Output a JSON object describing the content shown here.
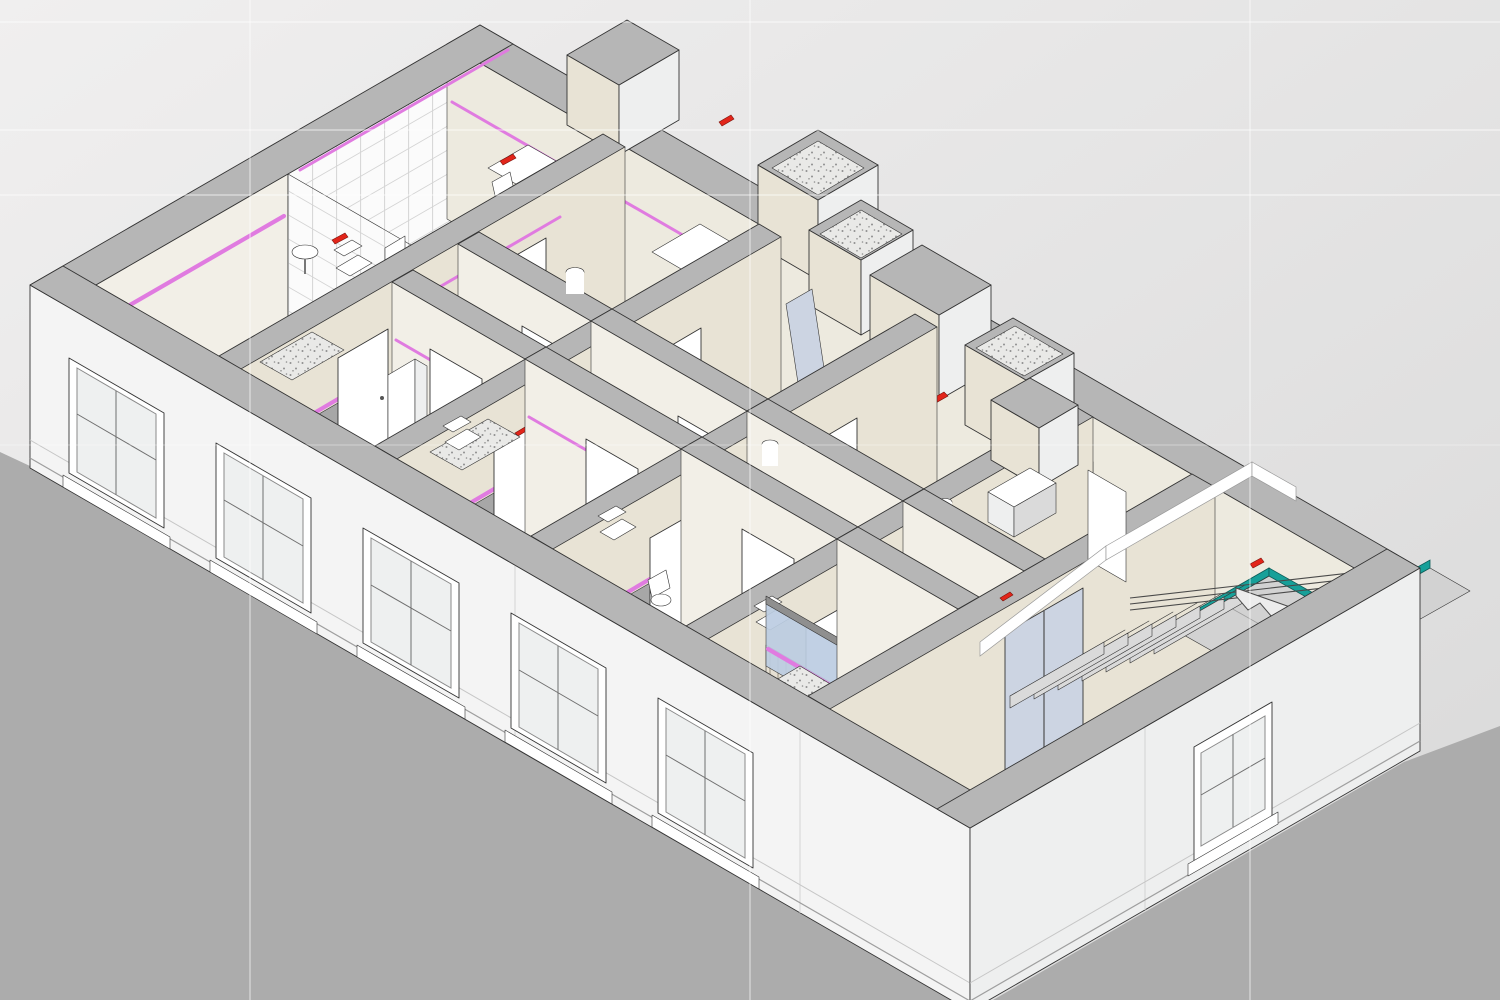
{
  "meta": {
    "view_type": "isometric-3d-cutaway",
    "subject": "building storey section-box render with furnished rooms, corridor, service shafts and stairwell"
  },
  "scene": {
    "elements": [
      "exterior-walls-white",
      "cut-wall-tops-gray",
      "facade-windows",
      "interior-partitions",
      "room-doors",
      "tiled-bathroom-with-bathtub",
      "entry-bathrooms-speckled-floor",
      "heating-pipes-magenta",
      "alarm-devices-red",
      "ventilation-shafts-speckled-tops",
      "glass-partition-rooms-blue",
      "pipe-chase-striped-walls",
      "u-stair-with-teal-nosing",
      "painted-handrail-stripe",
      "basement-stair",
      "washbasin",
      "toilets",
      "wall-cabinets",
      "desk-and-chairs",
      "ground-shadow",
      "viewport-grid-lines"
    ]
  },
  "colors": {
    "bgA": "#f0efef",
    "bgB": "#d9d9d9",
    "ground": "#acacac",
    "outline": "#343434",
    "wallTop": "#b6b6b6",
    "facade": "#f4f4f4",
    "facadeSide": "#eeefef",
    "faceSW": "#f2efe7",
    "faceSE": "#e8e3d5",
    "faceNE": "#edeadf",
    "faceGray": "#a7a7a7",
    "floor": "#e9e4d6",
    "floorCorridor": "#dfdacc",
    "floorTileGray": "#d2d2d2",
    "tileWhite": "#fbfbfb",
    "tileLine": "#d4d4d4",
    "speckBg": "#e9e9e7",
    "speckDot": "#8f8f8f",
    "stripeBg": "#e6e0d3",
    "stripeLine": "#a59d8f",
    "fixture": "#ffffff",
    "door": "#fbfbfb",
    "doorFrame": "#4f4f4f",
    "glassDoor": "#ccd4e2",
    "glassBlue": "#bccde2",
    "magenta": "#e07be0",
    "red": "#e2251a",
    "teal": "#17a099",
    "tealDark": "#0b5d59",
    "step": "#f3f3f3",
    "stepShade": "#dadada",
    "gridOverlay": "#ffffff7d"
  }
}
